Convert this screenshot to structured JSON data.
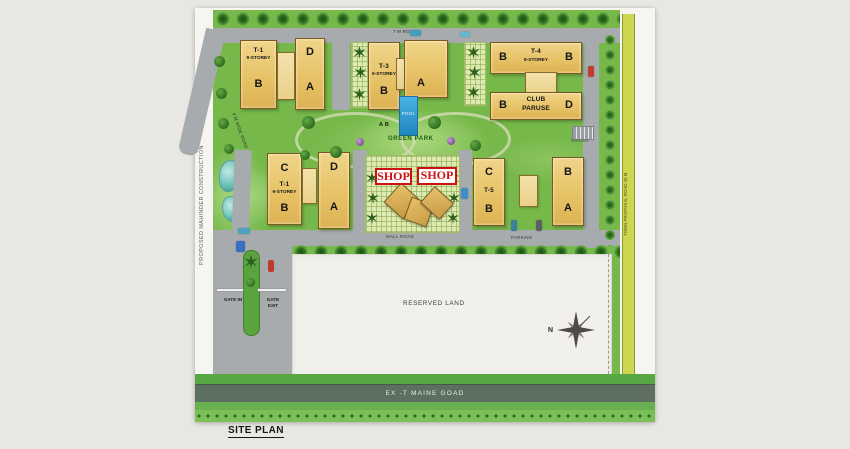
{
  "site": {
    "title": "SITE PLAN",
    "left_boundary_note": "PROPOSED MAHINDER CONSTRUCTION",
    "right_road_label": "TOWN PROPOSAL ROAD 45 M",
    "top_road_label": "7 M ROAD",
    "diagonal_road_label": "9 M WIDE ROAD",
    "mall_road_label": "MALL ROAD",
    "main_road_label": "EX -T MAINE GOAD",
    "parking_label": "PARKING",
    "parking_small_label": "PARKING",
    "green_park_label": "GREEN PARK",
    "reserved_land_label": "RESERVED LAND",
    "pool_label": "POOL",
    "pool_block_note": "A B",
    "gate_in_label": "GATE IN",
    "gate_exit_label": "GATE EXIT",
    "compass_north_label": "N"
  },
  "shops": {
    "sign1": "SHOP",
    "sign2": "SHOP"
  },
  "buildings": {
    "t1_top": {
      "name": "T-1",
      "storeys": "9-STOREY",
      "block_b": "B",
      "block_d": "D",
      "block_a": "A"
    },
    "t3": {
      "name": "T-3",
      "storeys": "9-STOREY",
      "block_b": "B",
      "block_a": "A"
    },
    "t4": {
      "name": "T-4",
      "storeys": "8-STOREY",
      "block_b_left": "B",
      "block_b_right": "B"
    },
    "club": {
      "name_line1": "CLUB",
      "name_line2": "PARUSE",
      "block_b": "B",
      "block_d": "D"
    },
    "t1_mid": {
      "name": "T-1",
      "storeys": "9-STOREY",
      "block_c": "C",
      "block_d": "D",
      "block_b": "B",
      "block_a": "A"
    },
    "t5": {
      "name": "T-5",
      "block_c": "C",
      "block_b_left": "B",
      "block_b_right": "B",
      "block_a": "A"
    }
  },
  "colors": {
    "lawn_green": "#76b84a",
    "road_gray": "#a7abad",
    "building_tan": "#e7c367",
    "pool_blue": "#2e9fd6",
    "shop_red": "#cc1111",
    "proposal_strip_yellow": "#ccd74f",
    "main_road_sage": "#5d6f61",
    "paper": "#f6f5f1",
    "reserved_land": "#f1f0ec"
  }
}
